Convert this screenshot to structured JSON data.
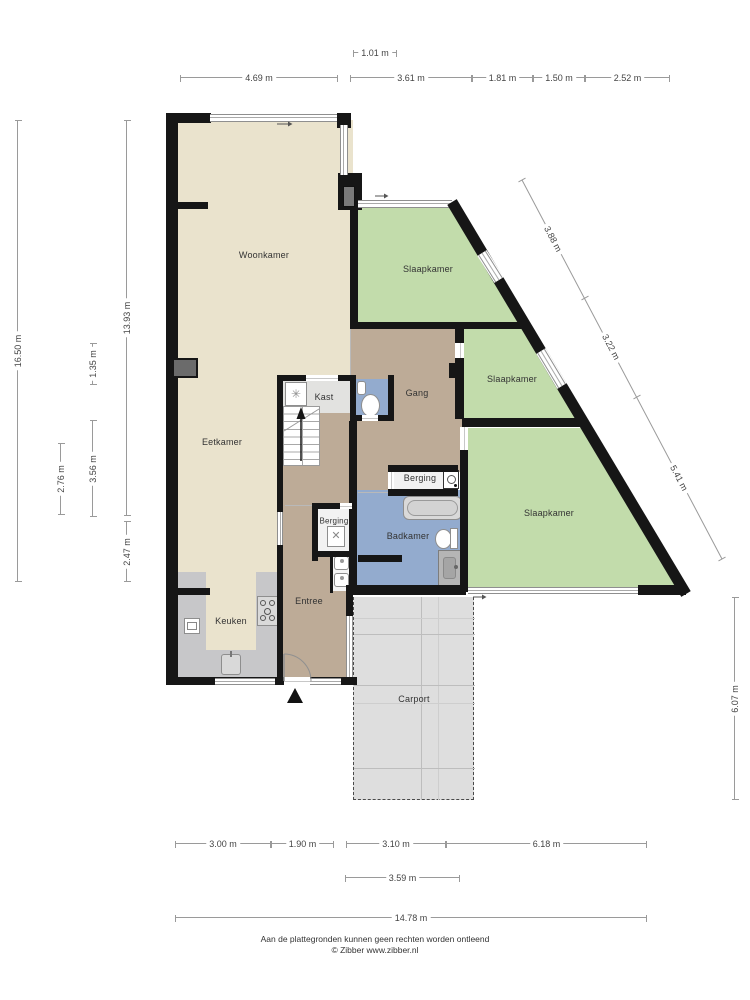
{
  "rooms": {
    "woonkamer": "Woonkamer",
    "slaapkamer1": "Slaapkamer",
    "slaapkamer2": "Slaapkamer",
    "slaapkamer3": "Slaapkamer",
    "eetkamer": "Eetkamer",
    "gang": "Gang",
    "kast": "Kast",
    "berging_hal": "Berging",
    "berging_washok": "Berging",
    "badkamer": "Badkamer",
    "keuken": "Keuken",
    "entree": "Entree",
    "carport": "Carport"
  },
  "dimensions": {
    "top_inset": "1.01 m",
    "top": [
      "4.69 m",
      "3.61 m",
      "1.81 m",
      "1.50 m",
      "2.52 m"
    ],
    "left_total": "16.50 m",
    "left_main": "13.93 m",
    "left_bottom": "2.47 m",
    "left_mid_upper": "1.35 m",
    "left_mid_lower": "3.56 m",
    "left_inner": "2.76 m",
    "diagonal": [
      "3.88 m",
      "3.22 m",
      "5.41 m"
    ],
    "right": "6.07 m",
    "bottom": [
      "3.00 m",
      "1.90 m",
      "3.10 m",
      "6.18 m"
    ],
    "bottom_carport": "3.59 m",
    "bottom_total": "14.78 m"
  },
  "footer": {
    "line1": "Aan de plattegronden kunnen geen rechten worden ontleend",
    "line2": "© Zibber www.zibber.nl"
  },
  "colors": {
    "wall": "#161616",
    "living_beige": "#eae3cd",
    "bedroom_green": "#c2dcab",
    "hall_brown": "#bdab97",
    "bath_blue": "#93abce",
    "storage_white": "#f2f2f2",
    "carport_grey": "#dedede",
    "counter_grey": "#c7c7c9"
  }
}
